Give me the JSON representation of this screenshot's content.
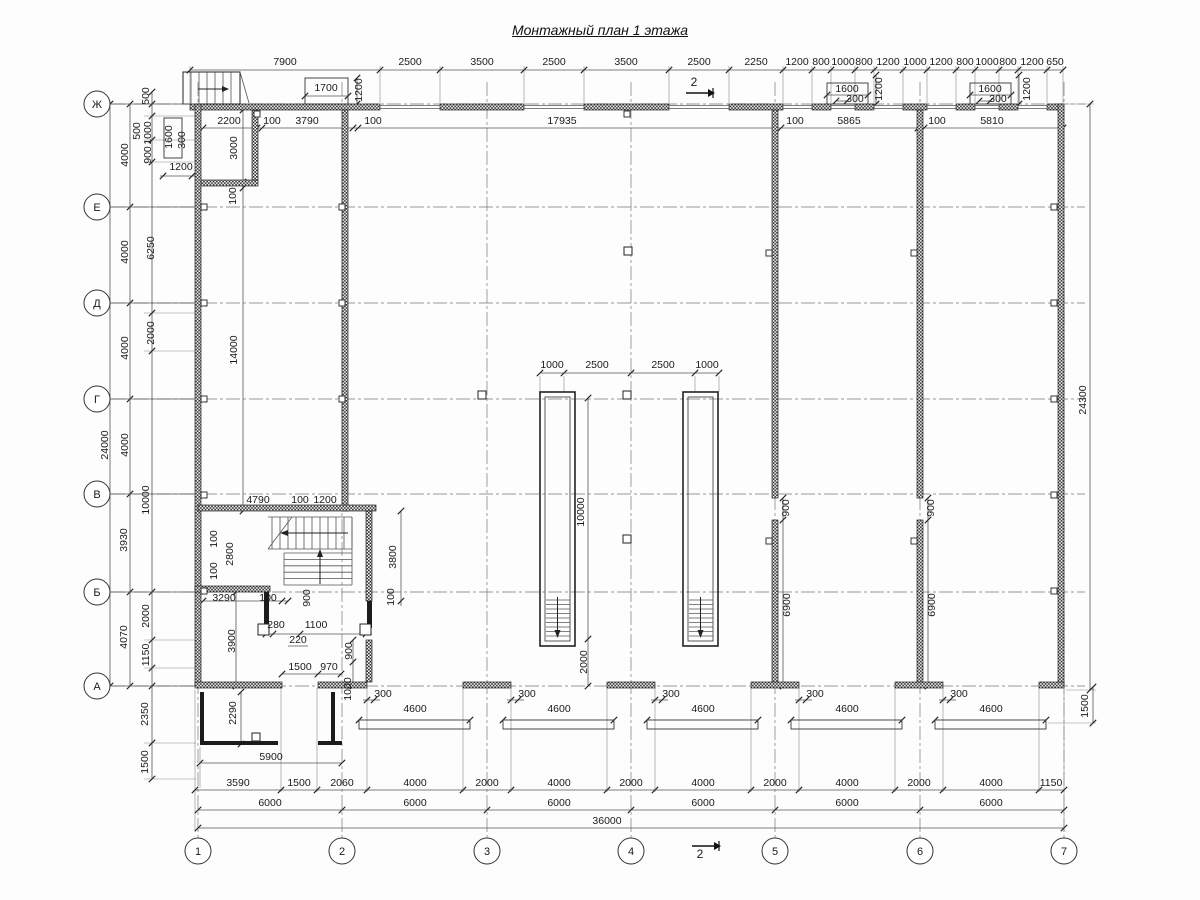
{
  "title": "Монтажный план 1 этажа",
  "axes": {
    "rows": [
      {
        "label": "Ж",
        "x": 97,
        "y": 104
      },
      {
        "label": "Е",
        "x": 97,
        "y": 207
      },
      {
        "label": "Д",
        "x": 97,
        "y": 303
      },
      {
        "label": "Г",
        "x": 97,
        "y": 399
      },
      {
        "label": "В",
        "x": 97,
        "y": 494
      },
      {
        "label": "Б",
        "x": 97,
        "y": 592
      },
      {
        "label": "А",
        "x": 97,
        "y": 686
      }
    ],
    "cols": [
      {
        "label": "1",
        "x": 198,
        "y": 851
      },
      {
        "label": "2",
        "x": 342,
        "y": 851
      },
      {
        "label": "3",
        "x": 487,
        "y": 851
      },
      {
        "label": "4",
        "x": 631,
        "y": 851
      },
      {
        "label": "5",
        "x": 775,
        "y": 851
      },
      {
        "label": "6",
        "x": 920,
        "y": 851
      },
      {
        "label": "7",
        "x": 1064,
        "y": 851
      }
    ]
  },
  "section_marks": [
    {
      "label": "2",
      "x": 694,
      "y": 86
    },
    {
      "label": "2",
      "x": 700,
      "y": 860
    }
  ],
  "dim_texts": [
    {
      "t": "7900",
      "x": 285,
      "y": 65
    },
    {
      "t": "2500",
      "x": 410,
      "y": 65
    },
    {
      "t": "3500",
      "x": 482,
      "y": 65
    },
    {
      "t": "2500",
      "x": 554,
      "y": 65
    },
    {
      "t": "3500",
      "x": 626,
      "y": 65
    },
    {
      "t": "2500",
      "x": 699,
      "y": 65
    },
    {
      "t": "2250",
      "x": 756,
      "y": 65
    },
    {
      "t": "1200",
      "x": 797,
      "y": 65
    },
    {
      "t": "800",
      "x": 821,
      "y": 65
    },
    {
      "t": "1000",
      "x": 843,
      "y": 65
    },
    {
      "t": "800",
      "x": 864,
      "y": 65
    },
    {
      "t": "1200",
      "x": 888,
      "y": 65
    },
    {
      "t": "1000",
      "x": 915,
      "y": 65
    },
    {
      "t": "1200",
      "x": 941,
      "y": 65
    },
    {
      "t": "800",
      "x": 965,
      "y": 65
    },
    {
      "t": "1000",
      "x": 987,
      "y": 65
    },
    {
      "t": "800",
      "x": 1008,
      "y": 65
    },
    {
      "t": "1200",
      "x": 1032,
      "y": 65
    },
    {
      "t": "650",
      "x": 1055,
      "y": 65
    },
    {
      "t": "1700",
      "x": 326,
      "y": 91
    },
    {
      "t": "1200",
      "x": 362,
      "y": 90,
      "r": 1
    },
    {
      "t": "1600",
      "x": 847,
      "y": 92
    },
    {
      "t": "300",
      "x": 855,
      "y": 102
    },
    {
      "t": "1200",
      "x": 882,
      "y": 89,
      "r": 1
    },
    {
      "t": "1600",
      "x": 990,
      "y": 92
    },
    {
      "t": "300",
      "x": 998,
      "y": 102
    },
    {
      "t": "1200",
      "x": 1030,
      "y": 89,
      "r": 1
    },
    {
      "t": "2200",
      "x": 229,
      "y": 124
    },
    {
      "t": "100",
      "x": 272,
      "y": 124
    },
    {
      "t": "3790",
      "x": 307,
      "y": 124
    },
    {
      "t": "100",
      "x": 373,
      "y": 124
    },
    {
      "t": "17935",
      "x": 562,
      "y": 124
    },
    {
      "t": "100",
      "x": 795,
      "y": 124
    },
    {
      "t": "5865",
      "x": 849,
      "y": 124
    },
    {
      "t": "100",
      "x": 937,
      "y": 124
    },
    {
      "t": "5810",
      "x": 992,
      "y": 124
    },
    {
      "t": "24000",
      "x": 108,
      "y": 445,
      "r": 1
    },
    {
      "t": "4000",
      "x": 128,
      "y": 155,
      "r": 1
    },
    {
      "t": "4000",
      "x": 128,
      "y": 252,
      "r": 1
    },
    {
      "t": "4000",
      "x": 128,
      "y": 348,
      "r": 1
    },
    {
      "t": "4000",
      "x": 128,
      "y": 445,
      "r": 1
    },
    {
      "t": "3930",
      "x": 127,
      "y": 540,
      "r": 1
    },
    {
      "t": "4070",
      "x": 127,
      "y": 637,
      "r": 1
    },
    {
      "t": "500",
      "x": 149,
      "y": 96,
      "r": 1
    },
    {
      "t": "500",
      "x": 140,
      "y": 131,
      "r": 1
    },
    {
      "t": "1000",
      "x": 151,
      "y": 133,
      "r": 1
    },
    {
      "t": "900",
      "x": 151,
      "y": 155,
      "r": 1
    },
    {
      "t": "6250",
      "x": 154,
      "y": 248,
      "r": 1
    },
    {
      "t": "2000",
      "x": 154,
      "y": 333,
      "r": 1
    },
    {
      "t": "10000",
      "x": 149,
      "y": 500,
      "r": 1
    },
    {
      "t": "2000",
      "x": 149,
      "y": 616,
      "r": 1
    },
    {
      "t": "1150",
      "x": 149,
      "y": 655,
      "r": 1
    },
    {
      "t": "2350",
      "x": 148,
      "y": 714,
      "r": 1
    },
    {
      "t": "1500",
      "x": 148,
      "y": 762,
      "r": 1
    },
    {
      "t": "1600",
      "x": 172,
      "y": 137,
      "r": 1
    },
    {
      "t": "300",
      "x": 185,
      "y": 140,
      "r": 1
    },
    {
      "t": "1200",
      "x": 181,
      "y": 170
    },
    {
      "t": "3000",
      "x": 237,
      "y": 148,
      "r": 1
    },
    {
      "t": "100",
      "x": 236,
      "y": 196,
      "r": 1
    },
    {
      "t": "14000",
      "x": 237,
      "y": 350,
      "r": 1
    },
    {
      "t": "24300",
      "x": 1086,
      "y": 400,
      "r": 1
    },
    {
      "t": "1500",
      "x": 1088,
      "y": 706,
      "r": 1
    },
    {
      "t": "900",
      "x": 789,
      "y": 508,
      "r": 1
    },
    {
      "t": "6900",
      "x": 790,
      "y": 605,
      "r": 1
    },
    {
      "t": "900",
      "x": 934,
      "y": 508,
      "r": 1
    },
    {
      "t": "6900",
      "x": 935,
      "y": 605,
      "r": 1
    },
    {
      "t": "1000",
      "x": 552,
      "y": 368
    },
    {
      "t": "2500",
      "x": 597,
      "y": 368
    },
    {
      "t": "2500",
      "x": 663,
      "y": 368
    },
    {
      "t": "1000",
      "x": 707,
      "y": 368
    },
    {
      "t": "10000",
      "x": 584,
      "y": 512,
      "r": 1
    },
    {
      "t": "2000",
      "x": 587,
      "y": 662,
      "r": 1
    },
    {
      "t": "4790",
      "x": 258,
      "y": 503
    },
    {
      "t": "100",
      "x": 300,
      "y": 503
    },
    {
      "t": "1200",
      "x": 325,
      "y": 503
    },
    {
      "t": "100",
      "x": 217,
      "y": 539,
      "r": 1
    },
    {
      "t": "2800",
      "x": 233,
      "y": 554,
      "r": 1
    },
    {
      "t": "100",
      "x": 217,
      "y": 571,
      "r": 1
    },
    {
      "t": "3800",
      "x": 396,
      "y": 557,
      "r": 1
    },
    {
      "t": "100",
      "x": 394,
      "y": 597,
      "r": 1
    },
    {
      "t": "3290",
      "x": 224,
      "y": 601
    },
    {
      "t": "100",
      "x": 268,
      "y": 601
    },
    {
      "t": "900",
      "x": 310,
      "y": 598,
      "r": 1
    },
    {
      "t": "280",
      "x": 276,
      "y": 628
    },
    {
      "t": "1100",
      "x": 316,
      "y": 628
    },
    {
      "t": "220",
      "x": 298,
      "y": 643
    },
    {
      "t": "3900",
      "x": 235,
      "y": 641,
      "r": 1
    },
    {
      "t": "1500",
      "x": 300,
      "y": 670
    },
    {
      "t": "970",
      "x": 329,
      "y": 670
    },
    {
      "t": "900",
      "x": 352,
      "y": 651,
      "r": 1
    },
    {
      "t": "1000",
      "x": 351,
      "y": 689,
      "r": 1
    },
    {
      "t": "2290",
      "x": 236,
      "y": 713,
      "r": 1
    },
    {
      "t": "5900",
      "x": 271,
      "y": 760
    },
    {
      "t": "300",
      "x": 383,
      "y": 697
    },
    {
      "t": "300",
      "x": 527,
      "y": 697
    },
    {
      "t": "300",
      "x": 671,
      "y": 697
    },
    {
      "t": "300",
      "x": 815,
      "y": 697
    },
    {
      "t": "300",
      "x": 959,
      "y": 697
    },
    {
      "t": "4600",
      "x": 415,
      "y": 712
    },
    {
      "t": "4600",
      "x": 559,
      "y": 712
    },
    {
      "t": "4600",
      "x": 703,
      "y": 712
    },
    {
      "t": "4600",
      "x": 847,
      "y": 712
    },
    {
      "t": "4600",
      "x": 991,
      "y": 712
    },
    {
      "t": "3590",
      "x": 238,
      "y": 786
    },
    {
      "t": "1500",
      "x": 299,
      "y": 786
    },
    {
      "t": "2060",
      "x": 342,
      "y": 786
    },
    {
      "t": "4000",
      "x": 415,
      "y": 786
    },
    {
      "t": "2000",
      "x": 487,
      "y": 786
    },
    {
      "t": "4000",
      "x": 559,
      "y": 786
    },
    {
      "t": "2000",
      "x": 631,
      "y": 786
    },
    {
      "t": "4000",
      "x": 703,
      "y": 786
    },
    {
      "t": "2000",
      "x": 775,
      "y": 786
    },
    {
      "t": "4000",
      "x": 847,
      "y": 786
    },
    {
      "t": "2000",
      "x": 919,
      "y": 786
    },
    {
      "t": "4000",
      "x": 991,
      "y": 786
    },
    {
      "t": "1150",
      "x": 1051,
      "y": 786
    },
    {
      "t": "6000",
      "x": 270,
      "y": 806
    },
    {
      "t": "6000",
      "x": 415,
      "y": 806
    },
    {
      "t": "6000",
      "x": 559,
      "y": 806
    },
    {
      "t": "6000",
      "x": 703,
      "y": 806
    },
    {
      "t": "6000",
      "x": 847,
      "y": 806
    },
    {
      "t": "6000",
      "x": 991,
      "y": 806
    },
    {
      "t": "36000",
      "x": 607,
      "y": 824
    }
  ]
}
